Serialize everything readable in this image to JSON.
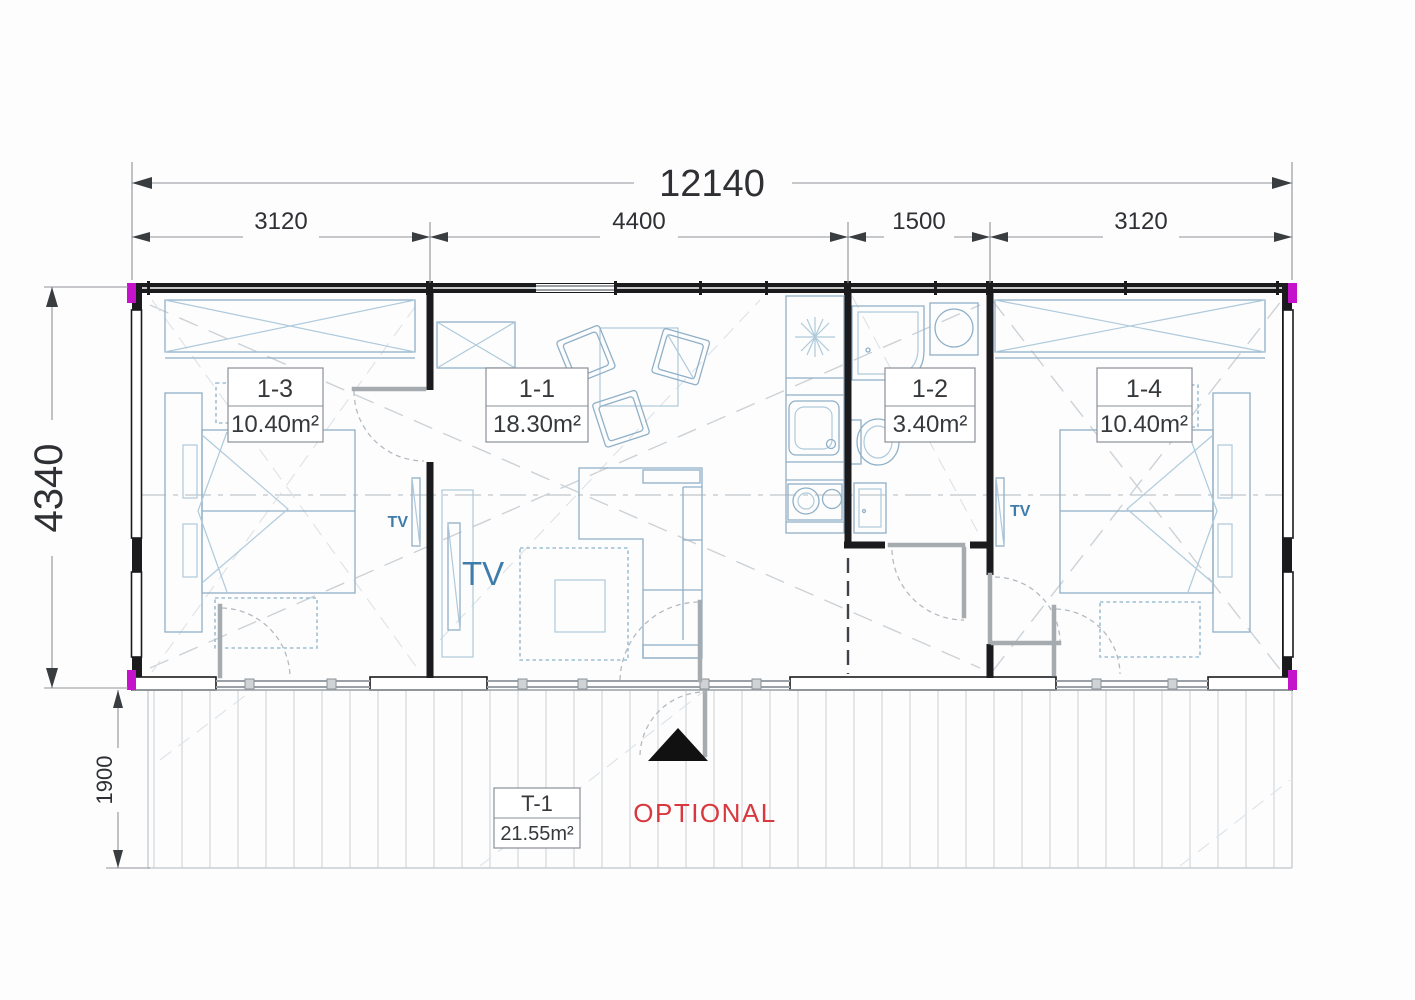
{
  "dimensions": {
    "overall_width": "12140",
    "width_segments": [
      "3120",
      "4400",
      "1500",
      "3120"
    ],
    "overall_depth": "4340",
    "terrace_depth": "1900"
  },
  "rooms": [
    {
      "id": "1-3",
      "area": "10.40m²"
    },
    {
      "id": "1-1",
      "area": "18.30m²"
    },
    {
      "id": "1-2",
      "area": "3.40m²"
    },
    {
      "id": "1-4",
      "area": "10.40m²"
    },
    {
      "id": "T-1",
      "area": "21.55m²"
    }
  ],
  "annotations": {
    "tv_bedroom_left": "TV",
    "tv_living": "TV",
    "tv_bedroom_right": "TV",
    "optional": "OPTIONAL"
  },
  "colors": {
    "wall": "#1b1b1d",
    "furniture_blue": "#8fb0c7",
    "tv_text_blue": "#3e7cab",
    "optional_red": "#d9383f",
    "corner_magenta": "#c513cc"
  }
}
